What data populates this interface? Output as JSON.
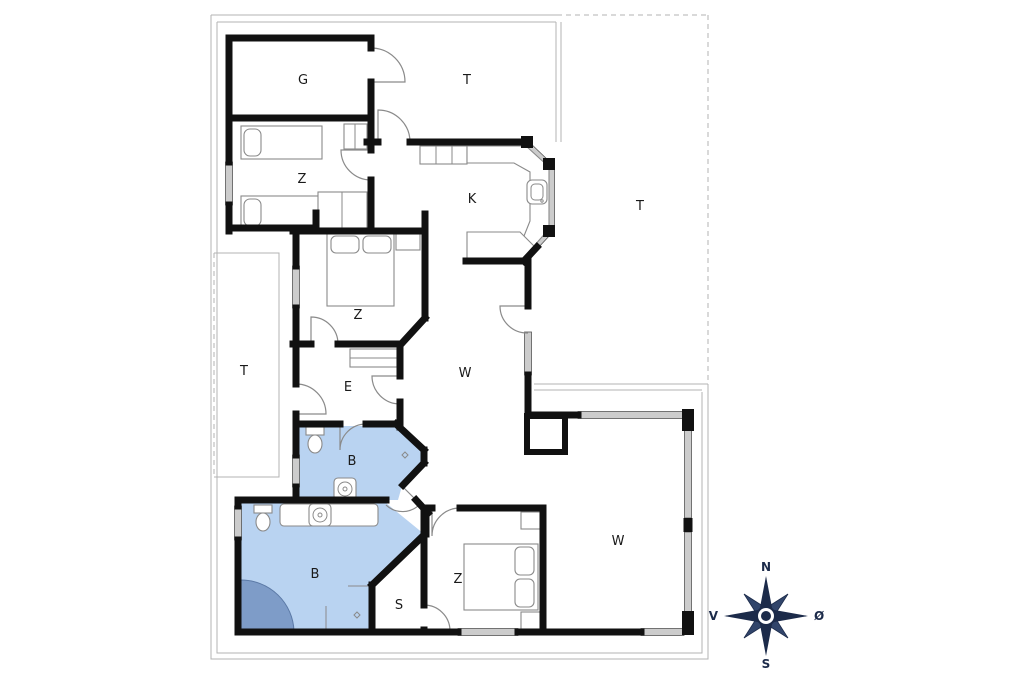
{
  "plan": {
    "type": "holiday-house-floor-plan",
    "rooms": [
      {
        "id": "garage",
        "label": "G"
      },
      {
        "id": "terrace-top",
        "label": "T"
      },
      {
        "id": "terrace-right",
        "label": "T"
      },
      {
        "id": "terrace-left",
        "label": "T"
      },
      {
        "id": "bedroom-top",
        "label": "Z"
      },
      {
        "id": "kitchen",
        "label": "K"
      },
      {
        "id": "bedroom-middle",
        "label": "Z"
      },
      {
        "id": "entry-hall",
        "label": "E"
      },
      {
        "id": "living-room",
        "label": "W"
      },
      {
        "id": "bathroom-top",
        "label": "B"
      },
      {
        "id": "bathroom-main",
        "label": "B"
      },
      {
        "id": "storage",
        "label": "S"
      },
      {
        "id": "bedroom-bottom",
        "label": "Z"
      },
      {
        "id": "living-room-ext",
        "label": "W"
      }
    ],
    "compass": {
      "north": "N",
      "south": "S",
      "west": "V",
      "east": "Ø"
    },
    "colors": {
      "wall": "#111111",
      "bathroom_fill": "#b9d3f1",
      "shower_fill": "#7e9cc8",
      "window_fill": "#cccccc",
      "compass": "#1c2b4a",
      "boundary_line": "#b3b3b3"
    },
    "icons": [
      "compass-rose-icon",
      "bed-icon",
      "toilet-icon",
      "sink-icon",
      "shower-icon",
      "door-arc-icon",
      "window-icon",
      "fireplace-icon"
    ]
  }
}
